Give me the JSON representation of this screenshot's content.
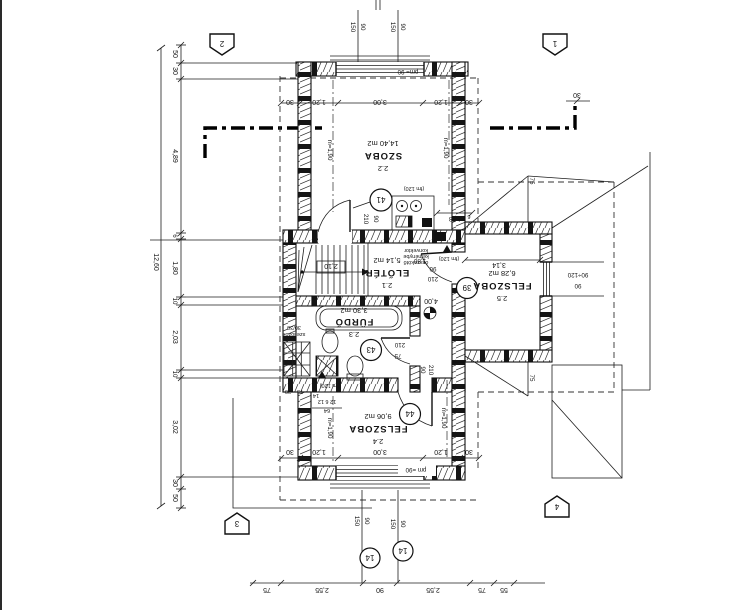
{
  "chains": {
    "left": [
      "50",
      "30",
      "4,89",
      "6",
      "1,80",
      "10",
      "2,03",
      "10",
      "3,02",
      "30",
      "50"
    ],
    "left_total": "12,60",
    "top": [
      "30",
      "1,20",
      "3,00",
      "1,20",
      "30"
    ],
    "top_right_offset": "30",
    "bottom_inner": [
      "30",
      "1,20",
      "3,00",
      "1,20",
      "30"
    ],
    "bottom_outer": [
      "75",
      "2,55",
      "90",
      "2,55",
      "75",
      "55"
    ]
  },
  "windows": {
    "top": {
      "w": "150",
      "h": "90"
    },
    "bottom": {
      "w": "150",
      "h": "90"
    },
    "parapet_top": "pm= 90",
    "parapet_bottom": "pm =90",
    "right": {
      "size": "90÷120",
      "sill": "90"
    }
  },
  "rooms": {
    "szoba": {
      "number": "2.2",
      "name": "SZOBA",
      "area": "14,40 m2",
      "height_left": "m=1,90",
      "height_right": "m=1,90"
    },
    "eloter": {
      "number": "2.1",
      "name": "ELŐTÉR",
      "area": "5,14 m2"
    },
    "furdo": {
      "number": "2.3",
      "name": "FÜRDŐ",
      "area": "3,30 m2"
    },
    "felszoba_also": {
      "number": "2.4",
      "name": "FELSZOBA",
      "area": "9,06 m2",
      "height_left": "m=1,90",
      "height_right": "m=1,90"
    },
    "felszoba_jobb": {
      "number": "2.5",
      "name": "FELSZOBA",
      "area": "6,28 m2",
      "width": "3,14"
    }
  },
  "doors": {
    "d41": {
      "no": "41",
      "w": "90",
      "h": "210"
    },
    "d39": {
      "no": "39",
      "w": "90",
      "h": "210"
    },
    "d43": {
      "no": "43",
      "w": "75",
      "h": "210"
    },
    "d44": {
      "no": "44",
      "w": "90",
      "h": "210"
    }
  },
  "markers": {
    "m1": "1",
    "m2": "2",
    "m3": "3",
    "m4": "4",
    "w14": "14"
  },
  "labels": {
    "level": "4,00",
    "stair": "2,10",
    "hall": "1,80",
    "nook": "1,58",
    "dormer75": "75",
    "eave6": "6",
    "fm120": "(fm 120)",
    "note1": "összekötő",
    "note2": "kéménybe",
    "note3": "konvektor",
    "vent1": "szellőzők",
    "vent2": "30/30",
    "d64": "64",
    "d14": "14",
    "d1262": "12 6 12",
    "d30": "30",
    "d75": "75"
  }
}
